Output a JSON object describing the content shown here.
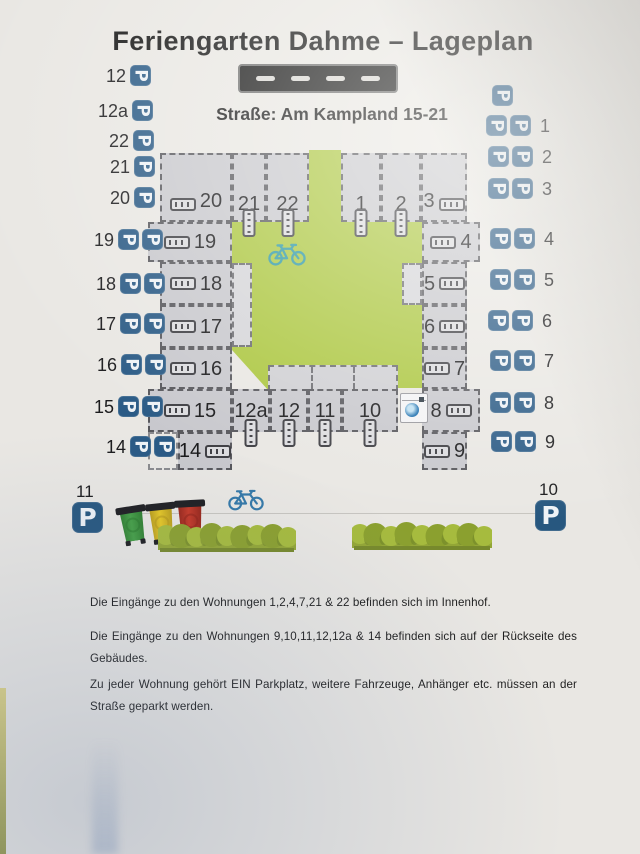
{
  "header": {
    "title": "Feriengarten Dahme – Lageplan",
    "street_label": "Straße: Am Kampland 15-21"
  },
  "icons": {
    "parking_glyph": "P",
    "parking": "parking-sign",
    "bicycle": "bicycle-icon",
    "washing_machine": "washing-machine-icon",
    "door": "entrance-door-icon",
    "road": "road-with-lane-dashes",
    "bin": "wheelie-bin-icon",
    "hedge": "hedge-icon"
  },
  "colors": {
    "parking_blue": "#2a5a85",
    "courtyard_green": "#abc63e",
    "unit_gray": "#c8c8cd",
    "paper": "#e9e7e3",
    "road_black": "#191919"
  },
  "parking_left": {
    "rows": [
      {
        "label": "12",
        "p": 1,
        "x": 130,
        "y": 65
      },
      {
        "label": "12a",
        "p": 1,
        "x": 132,
        "y": 100
      },
      {
        "label": "22",
        "p": 1,
        "x": 133,
        "y": 130
      },
      {
        "label": "21",
        "p": 1,
        "x": 134,
        "y": 156
      },
      {
        "label": "20",
        "p": 1,
        "x": 134,
        "y": 187
      },
      {
        "label": "19",
        "p": 2,
        "x": 118,
        "y": 229
      },
      {
        "label": "18",
        "p": 2,
        "x": 120,
        "y": 273
      },
      {
        "label": "17",
        "p": 2,
        "x": 120,
        "y": 313
      },
      {
        "label": "16",
        "p": 2,
        "x": 121,
        "y": 354
      },
      {
        "label": "15",
        "p": 2,
        "x": 118,
        "y": 396
      },
      {
        "label": "14",
        "p": 2,
        "x": 130,
        "y": 436
      }
    ]
  },
  "parking_right": {
    "rows": [
      {
        "label": "",
        "p": 1,
        "x": 492,
        "y": 85
      },
      {
        "label": "1",
        "p": 2,
        "x": 486,
        "y": 115
      },
      {
        "label": "2",
        "p": 2,
        "x": 488,
        "y": 146
      },
      {
        "label": "3",
        "p": 2,
        "x": 488,
        "y": 178
      },
      {
        "label": "4",
        "p": 2,
        "x": 490,
        "y": 228
      },
      {
        "label": "5",
        "p": 2,
        "x": 490,
        "y": 269
      },
      {
        "label": "6",
        "p": 2,
        "x": 488,
        "y": 310
      },
      {
        "label": "7",
        "p": 2,
        "x": 490,
        "y": 350
      },
      {
        "label": "8",
        "p": 2,
        "x": 490,
        "y": 392
      },
      {
        "label": "9",
        "p": 2,
        "x": 491,
        "y": 431
      }
    ]
  },
  "site_plan": {
    "units": [
      {
        "label": "20",
        "x": 160,
        "y": 153,
        "w": 72,
        "h": 69,
        "door": "before",
        "group": "top"
      },
      {
        "label": "21",
        "x": 232,
        "y": 153,
        "w": 34,
        "h": 69,
        "door": "below",
        "group": "top"
      },
      {
        "label": "22",
        "x": 266,
        "y": 153,
        "w": 43,
        "h": 69,
        "door": "below",
        "group": "top"
      },
      {
        "label": "1",
        "x": 341,
        "y": 153,
        "w": 40,
        "h": 69,
        "door": "below",
        "group": "top"
      },
      {
        "label": "2",
        "x": 381,
        "y": 153,
        "w": 40,
        "h": 69,
        "door": "below",
        "group": "top"
      },
      {
        "label": "3",
        "x": 421,
        "y": 153,
        "w": 46,
        "h": 69,
        "door": "after",
        "group": "top"
      },
      {
        "label": "19",
        "x": 148,
        "y": 222,
        "w": 84,
        "h": 40,
        "door": "before",
        "group": "left"
      },
      {
        "label": "18",
        "x": 160,
        "y": 262,
        "w": 72,
        "h": 43,
        "door": "before",
        "group": "left"
      },
      {
        "label": "17",
        "x": 160,
        "y": 305,
        "w": 72,
        "h": 43,
        "door": "before",
        "group": "left"
      },
      {
        "label": "16",
        "x": 160,
        "y": 348,
        "w": 72,
        "h": 41,
        "door": "before",
        "group": "left"
      },
      {
        "label": "15",
        "x": 148,
        "y": 389,
        "w": 84,
        "h": 43,
        "door": "before",
        "group": "left"
      },
      {
        "label": "14",
        "x": 178,
        "y": 432,
        "w": 54,
        "h": 38,
        "door": "after",
        "group": "left"
      },
      {
        "label": "4",
        "x": 422,
        "y": 222,
        "w": 58,
        "h": 40,
        "door": "before",
        "group": "right"
      },
      {
        "label": "5",
        "x": 422,
        "y": 262,
        "w": 45,
        "h": 43,
        "door": "after",
        "group": "right"
      },
      {
        "label": "6",
        "x": 422,
        "y": 305,
        "w": 45,
        "h": 43,
        "door": "after",
        "group": "right"
      },
      {
        "label": "7",
        "x": 422,
        "y": 348,
        "w": 45,
        "h": 41,
        "door": "before",
        "group": "right"
      },
      {
        "label": "8",
        "x": 422,
        "y": 389,
        "w": 58,
        "h": 43,
        "door": "after",
        "group": "right"
      },
      {
        "label": "9",
        "x": 422,
        "y": 432,
        "w": 45,
        "h": 38,
        "door": "before",
        "group": "right"
      },
      {
        "label": "12a",
        "x": 232,
        "y": 389,
        "w": 38,
        "h": 43,
        "door": "below",
        "group": "bottom"
      },
      {
        "label": "12",
        "x": 270,
        "y": 389,
        "w": 38,
        "h": 43,
        "door": "below",
        "group": "bottom"
      },
      {
        "label": "11",
        "x": 308,
        "y": 389,
        "w": 34,
        "h": 43,
        "door": "below",
        "group": "bottom"
      },
      {
        "label": "10",
        "x": 342,
        "y": 389,
        "w": 56,
        "h": 43,
        "door": "below",
        "group": "bottom"
      }
    ]
  },
  "street_corner": {
    "left_label": "11",
    "right_label": "10"
  },
  "landscape": {
    "bins": [
      {
        "name": "green-bin",
        "color": "#46a047",
        "dark": "#2c7a2d",
        "x": 120,
        "y": 506,
        "w": 26,
        "h": 39,
        "tilt": -9
      },
      {
        "name": "yellow-bin",
        "color": "#e5c726",
        "dark": "#b2961a",
        "x": 149,
        "y": 503,
        "w": 26,
        "h": 41,
        "tilt": -6
      },
      {
        "name": "red-bin",
        "color": "#c53a29",
        "dark": "#8f2318",
        "x": 177,
        "y": 500,
        "w": 27,
        "h": 43,
        "tilt": -3
      }
    ],
    "hedges": [
      {
        "x": 158,
        "y": 523,
        "w": 138,
        "h": 30
      },
      {
        "x": 352,
        "y": 522,
        "w": 140,
        "h": 29
      }
    ],
    "bikes": [
      {
        "x": 268,
        "y": 241,
        "w": 38,
        "color": "#2e98a4"
      },
      {
        "x": 228,
        "y": 487,
        "w": 36,
        "color": "#3579a8"
      }
    ],
    "ground_line": {
      "x1": 118,
      "x2": 546,
      "y": 513
    }
  },
  "notes": [
    "Die Eingänge zu den Wohnungen 1,2,4,7,21 & 22 befinden sich im Innenhof.",
    "Die Eingänge zu den Wohnungen 9,10,11,12,12a & 14 befinden sich auf der Rückseite des Gebäudes.",
    "Zu jeder Wohnung gehört EIN Parkplatz, weitere Fahrzeuge, Anhänger etc. müssen an der Straße geparkt werden."
  ]
}
